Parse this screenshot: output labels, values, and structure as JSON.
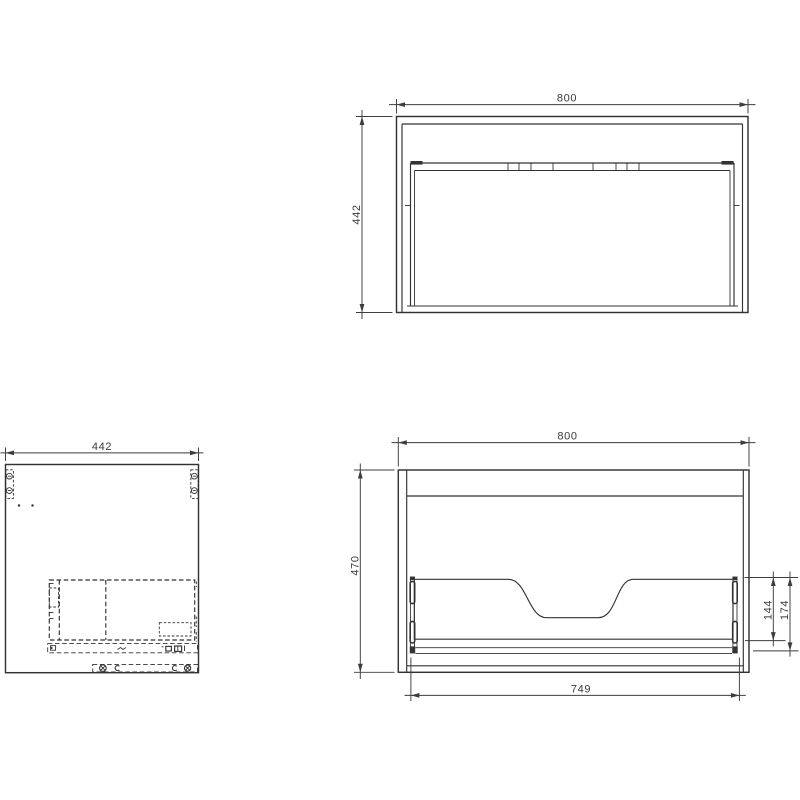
{
  "drawing": {
    "background": "#ffffff",
    "line_color": "#333333",
    "dim_color": "#3d3d3d",
    "views": {
      "top": {
        "name": "top view (plan)",
        "width": "800",
        "depth": "442"
      },
      "side": {
        "name": "side view (panel with hidden hardware)",
        "width": "442"
      },
      "front": {
        "name": "front view (section)",
        "width": "800",
        "height": "470",
        "drawer_opening_width": "749",
        "drawer_back_height": "144",
        "drawer_total_height": "174"
      }
    }
  }
}
